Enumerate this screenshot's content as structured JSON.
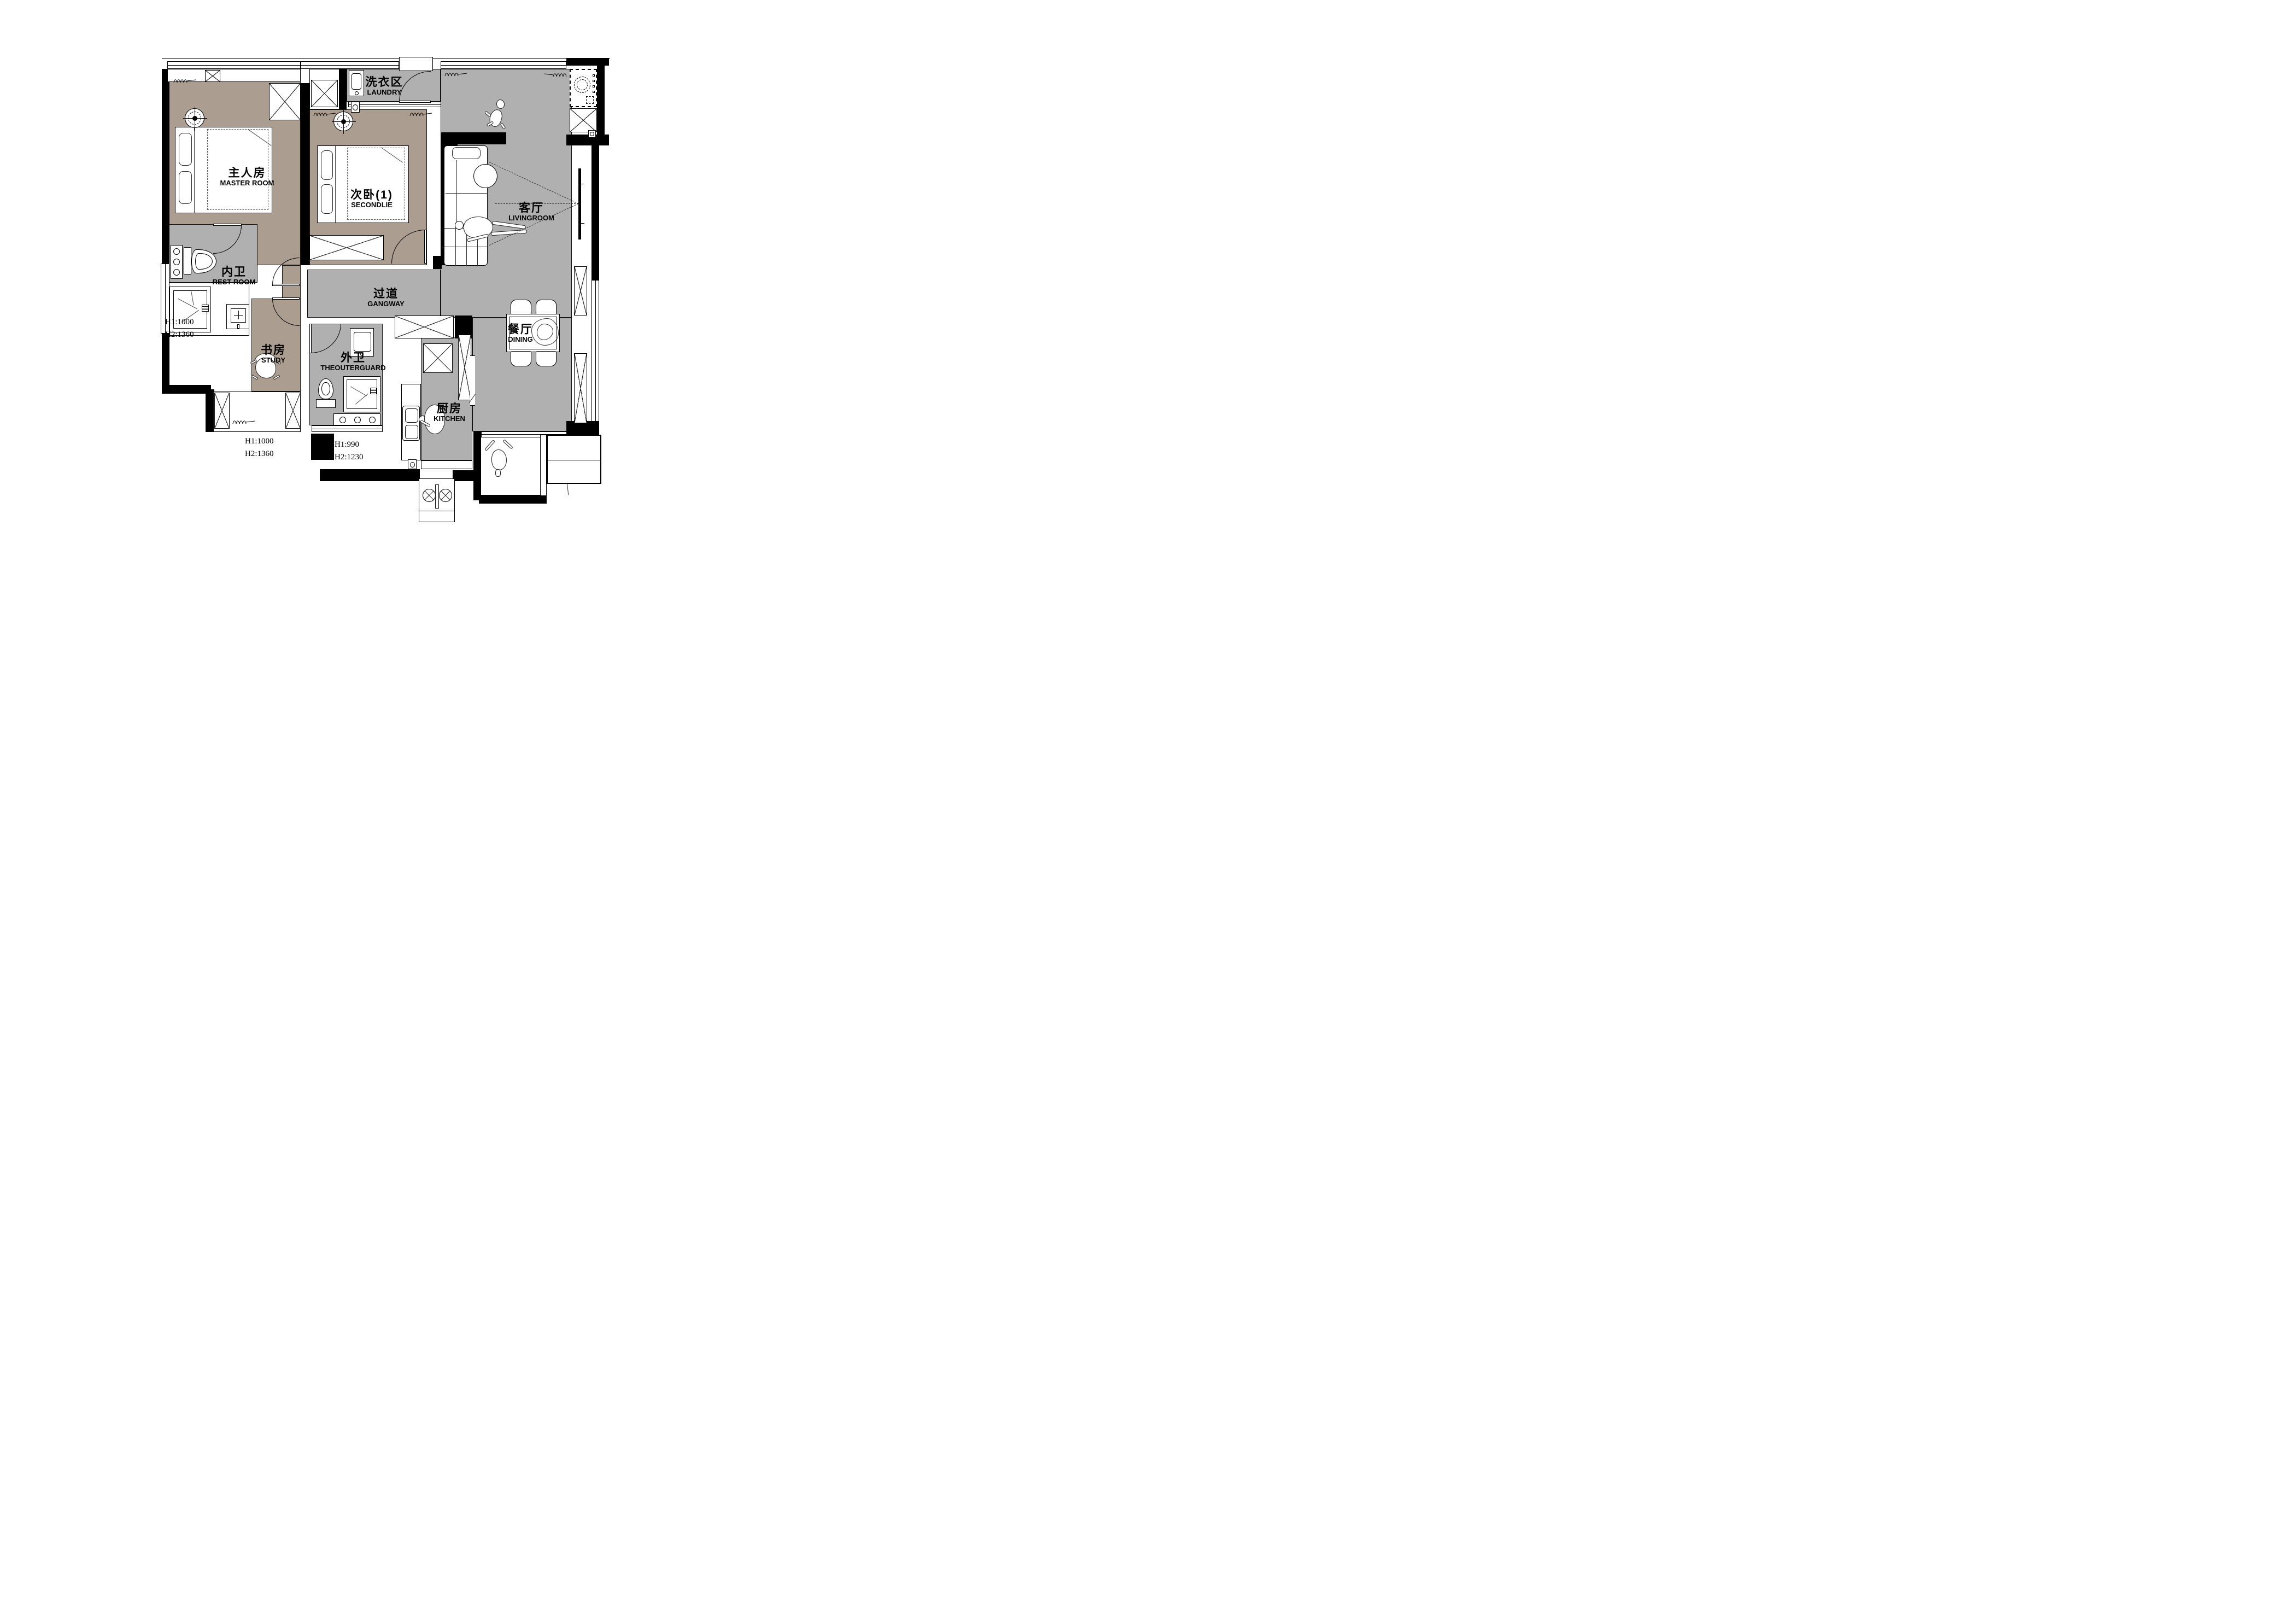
{
  "colors": {
    "floor_warm": "#ab9e90",
    "floor_gray": "#b0b0b0",
    "wall": "#000000",
    "background": "#ffffff"
  },
  "rooms": [
    {
      "id": "master",
      "zh": "主人房",
      "en": "MASTER ROOM"
    },
    {
      "id": "second",
      "zh": "次卧(1)",
      "en": "SECONDLIE"
    },
    {
      "id": "laundry",
      "zh": "洗衣区",
      "en": "LAUNDRY"
    },
    {
      "id": "living",
      "zh": "客厅",
      "en": "LIVINGROOM"
    },
    {
      "id": "restroom",
      "zh": "内卫",
      "en": "REST ROOM"
    },
    {
      "id": "gangway",
      "zh": "过道",
      "en": "GANGWAY"
    },
    {
      "id": "study",
      "zh": "书房",
      "en": "STUDY"
    },
    {
      "id": "outerguard",
      "zh": "外卫",
      "en": "THEOUTERGUARD"
    },
    {
      "id": "kitchen",
      "zh": "厨房",
      "en": "KITCHEN"
    },
    {
      "id": "dining",
      "zh": "餐厅",
      "en": "DINING"
    }
  ],
  "annotations": [
    {
      "id": "left-bay",
      "lines": [
        "H1:1000",
        "H2:1360"
      ]
    },
    {
      "id": "study-bay",
      "lines": [
        "H1:1000",
        "H2:1360"
      ]
    },
    {
      "id": "outer-bay",
      "lines": [
        "H1:990",
        "H2:1230"
      ]
    }
  ]
}
